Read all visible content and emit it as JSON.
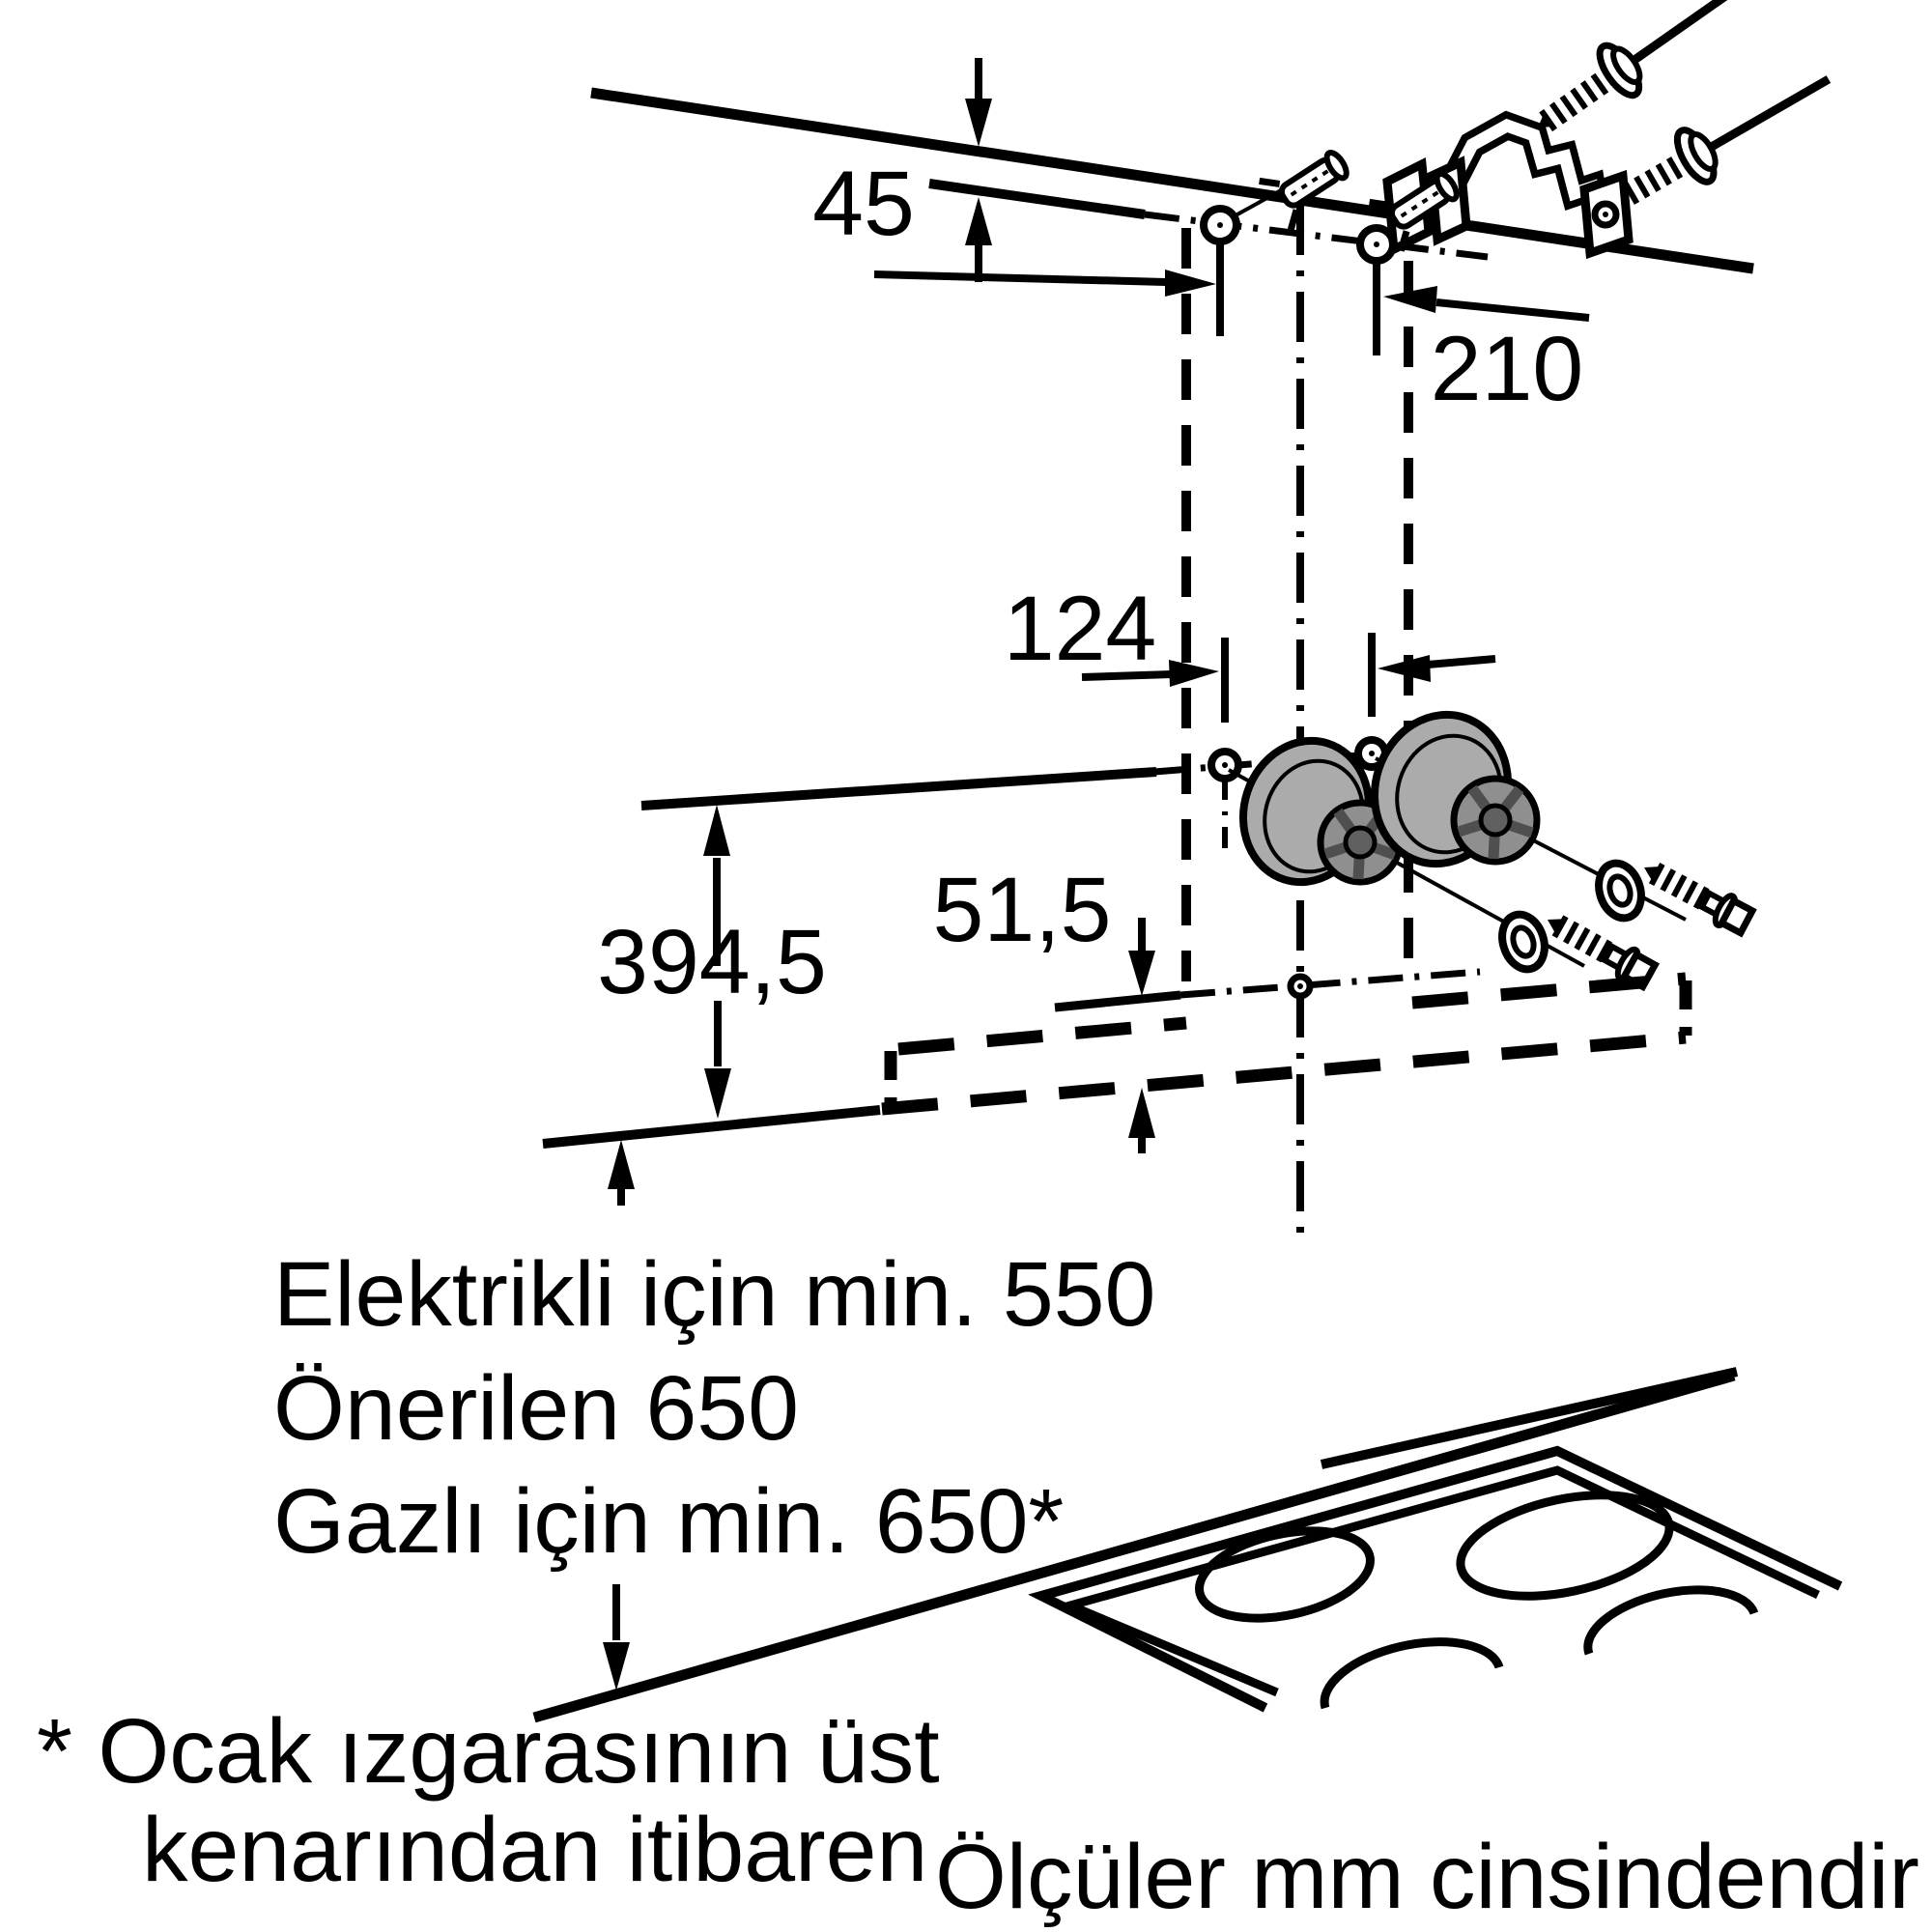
{
  "diagram": {
    "type": "installation-drawing",
    "product": "wall-mounted cooker hood mounting diagram",
    "dimensions": {
      "ceiling_offset": "45",
      "top_hole_spacing": "210",
      "lower_hole_spacing": "124",
      "chimney_height": "394,5",
      "lower_edge_offset": "51,5"
    },
    "notes": {
      "electric": "Elektrikli için min. 550",
      "recommended": "Önerilen 650",
      "gas": "Gazlı için min. 650*",
      "footnote1": "* Ocak ızgarasının üst",
      "footnote2": "kenarından itibaren",
      "units": "Ölçüler mm cinsindendir"
    },
    "colors": {
      "line": "#000000",
      "background": "#ffffff",
      "spacer_body": "#ababab",
      "spacer_face": "#8f8f8f",
      "spacer_hub": "#606060"
    }
  }
}
